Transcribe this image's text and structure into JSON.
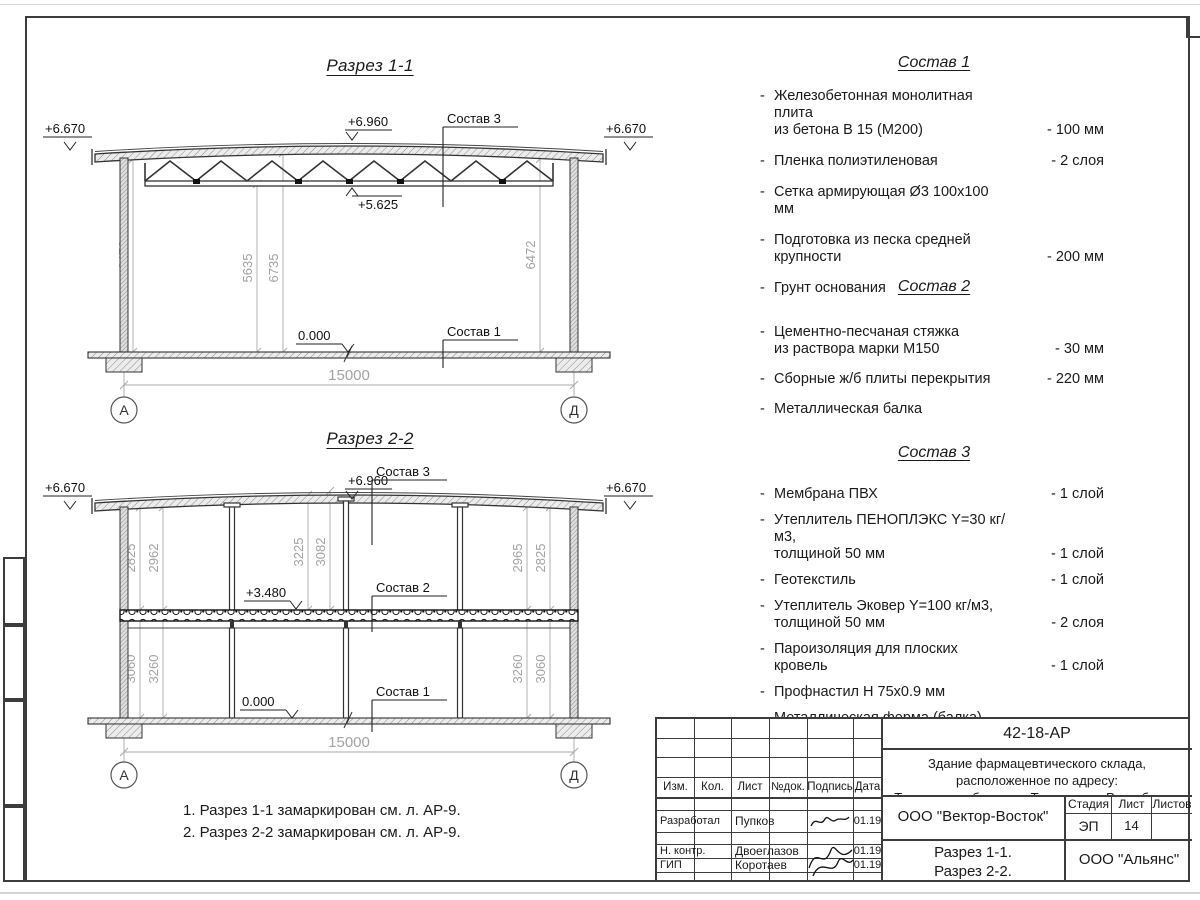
{
  "section1": {
    "title": "Разрез 1-1",
    "elev_left": "+6.670",
    "elev_right": "+6.670",
    "elev_ridge": "+6.960",
    "elev_truss": "+5.625",
    "elev_floor": "0.000",
    "label_sostav3": "Состав 3",
    "label_sostav1": "Состав 1",
    "dim_left": "6472",
    "dim_mid1": "5635",
    "dim_mid2": "6735",
    "dim_right": "6472",
    "dim_span": "15000",
    "axis_left": "А",
    "axis_right": "Д"
  },
  "section2": {
    "title": "Разрез 2-2",
    "elev_left": "+6.670",
    "elev_right": "+6.670",
    "elev_ridge": "+6.960",
    "elev_mid": "+3.480",
    "elev_floor": "0.000",
    "label_sostav3": "Состав 3",
    "label_sostav2": "Состав 2",
    "label_sostav1": "Состав 1",
    "dims_upper": [
      "2825",
      "2962",
      "3225",
      "3082",
      "2965",
      "2825"
    ],
    "dims_lower": [
      "3060",
      "3260",
      "3260",
      "3060"
    ],
    "dim_span": "15000",
    "axis_left": "А",
    "axis_right": "Д"
  },
  "compositions": [
    {
      "title": "Состав 1",
      "items": [
        {
          "dash": "-",
          "text": "Железобетонная  монолитная плита",
          "text2": "из бетона В 15 (М200)",
          "value": "- 100 мм"
        },
        {
          "dash": "-",
          "text": "Пленка полиэтиленовая",
          "value": "-  2 слоя"
        },
        {
          "dash": "-",
          "text": "Сетка армирующая Ø3 100х100 мм",
          "value": ""
        },
        {
          "dash": "-",
          "text": "Подготовка из песка средней",
          "text2": "крупности",
          "value": "- 200 мм"
        },
        {
          "dash": "-",
          "text": "Грунт основания",
          "value": ""
        }
      ]
    },
    {
      "title": "Состав 2",
      "items": [
        {
          "dash": "-",
          "text": "Цементно-песчаная стяжка",
          "text2": "из раствора марки М150",
          "value": "- 30 мм"
        },
        {
          "dash": "-",
          "text": "Сборные ж/б плиты перекрытия",
          "value": "- 220 мм"
        },
        {
          "dash": "-",
          "text": "Металлическая балка",
          "value": ""
        }
      ]
    },
    {
      "title": "Состав 3",
      "items": [
        {
          "dash": "-",
          "text": "Мембрана ПВХ",
          "value": "- 1 слой"
        },
        {
          "dash": "-",
          "text": "Утеплитель ПЕНОПЛЭКС Y=30 кг/м3,",
          "text2": "толщиной 50 мм",
          "value": "- 1 слой"
        },
        {
          "dash": "-",
          "text": "Геотекстиль",
          "value": "- 1 слой"
        },
        {
          "dash": "-",
          "text": "Утеплитель Эковер Y=100 кг/м3,",
          "text2": "толщиной 50 мм",
          "value": "- 2 слоя"
        },
        {
          "dash": "-",
          "text": "Пароизоляция для плоских кровель",
          "value": "- 1 слой"
        },
        {
          "dash": "-",
          "text": "Профнастил Н 75х0.9 мм",
          "value": ""
        },
        {
          "dash": "-",
          "text": "Металлическая ферма (балка)",
          "value": ""
        }
      ]
    }
  ],
  "notes": [
    "1. Разрез 1-1 замаркирован см. л. АР-9.",
    "2. Разрез 2-2 замаркирован см. л. АР-9."
  ],
  "titleblock": {
    "doc_code": "42-18-АР",
    "project_line1": "Здание фармацевтического склада, расположенное по адресу:",
    "project_line2": "Тюменская область, г. Тюмень, ул. Республики.",
    "cols": {
      "izm": "Изм.",
      "kol": "Кол.",
      "list": "Лист",
      "ndok": "№док.",
      "podpis": "Подпись",
      "data": "Дата"
    },
    "rows": [
      {
        "role": "Разработал",
        "name": "Пупков",
        "date": "01.19"
      },
      {
        "role": "Н. контр.",
        "name": "Двоеглазов",
        "date": "01.19"
      },
      {
        "role": "ГИП",
        "name": "Коротаев",
        "date": "01.19"
      }
    ],
    "company": "ООО \"Вектор-Восток\"",
    "stage_label": "Стадия",
    "sheet_label": "Лист",
    "sheets_label": "Листов",
    "stage": "ЭП",
    "sheet_num": "14",
    "sheets_total": "",
    "sheet_title_line1": "Разрез 1-1.",
    "sheet_title_line2": "Разрез 2-2.",
    "firm": "ООО \"Альянс\""
  }
}
